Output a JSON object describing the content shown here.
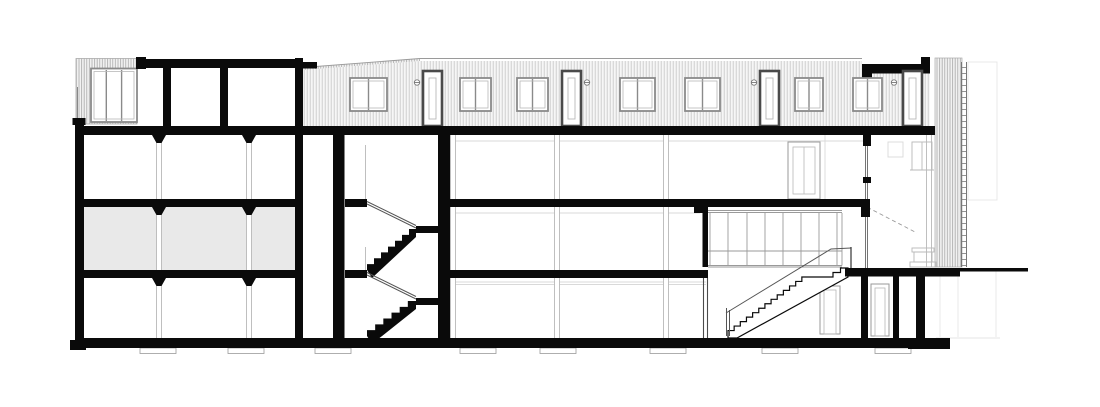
{
  "figure": {
    "title": "Longitudinal building section — multi-storey block with rooftop pavilion, central dog-leg stair and grand single-flight stair",
    "type": "architectural section drawing",
    "drawing_style": "black ink linework on white paper",
    "shaded_room": "middle-floor left bay (grey fill)"
  },
  "colors": {
    "ink": "#0a0a0a",
    "paper": "#ffffff",
    "room_shade": "#e9e9e9",
    "frame_dark": "#4a4a4a",
    "frame_mid": "#8a8a8a",
    "line_light": "#b8b8b8",
    "line_faint": "#d9d9d9",
    "hatch_line": "#c6c6c6",
    "hatch_line_dense": "#a8a8a8",
    "rail": "#555555"
  },
  "top_floor": {
    "facade_windows": [
      {
        "x": 350,
        "w": 37
      },
      {
        "x": 460,
        "w": 31
      },
      {
        "x": 517,
        "w": 31
      },
      {
        "x": 620,
        "w": 35
      },
      {
        "x": 685,
        "w": 35
      },
      {
        "x": 795,
        "w": 28
      },
      {
        "x": 853,
        "w": 29
      }
    ],
    "facade_doors": [
      423,
      562,
      760,
      903
    ],
    "vents": [
      417,
      587,
      754,
      894
    ]
  },
  "structure": {
    "levels": [
      {
        "name": "upper-floor",
        "y0": 135,
        "y1": 199
      },
      {
        "name": "middle-floor",
        "y0": 207,
        "y1": 270
      },
      {
        "name": "ground-floor",
        "y0": 278,
        "y1": 338
      }
    ],
    "columns_with_capitals": [
      159,
      249
    ],
    "columns_plain": [
      453,
      557,
      666
    ],
    "footings": [
      140,
      228,
      315,
      460,
      540,
      650,
      762,
      875
    ],
    "glazed_wall_mullions": [
      710,
      728,
      747,
      765,
      783,
      801,
      819,
      837
    ]
  },
  "stairs": {
    "central": {
      "flights": [
        {
          "x1": 367,
          "y1": 270,
          "x2": 416,
          "y2": 229,
          "steps": 7
        },
        {
          "x1": 367,
          "y1": 336,
          "x2": 416,
          "y2": 301,
          "steps": 6
        }
      ],
      "landings": [
        [
          345,
          199,
          22,
          8
        ],
        [
          345,
          270,
          22,
          8
        ],
        [
          416,
          226,
          22,
          7
        ],
        [
          416,
          298,
          22,
          7
        ]
      ]
    },
    "grand": {
      "runs": [
        {
          "x1": 728,
          "y1": 335,
          "x2": 808,
          "y2": 277,
          "steps": 13
        },
        {
          "x1": 833,
          "y1": 277,
          "x2": 848,
          "y2": 268,
          "steps": 2
        }
      ]
    }
  }
}
